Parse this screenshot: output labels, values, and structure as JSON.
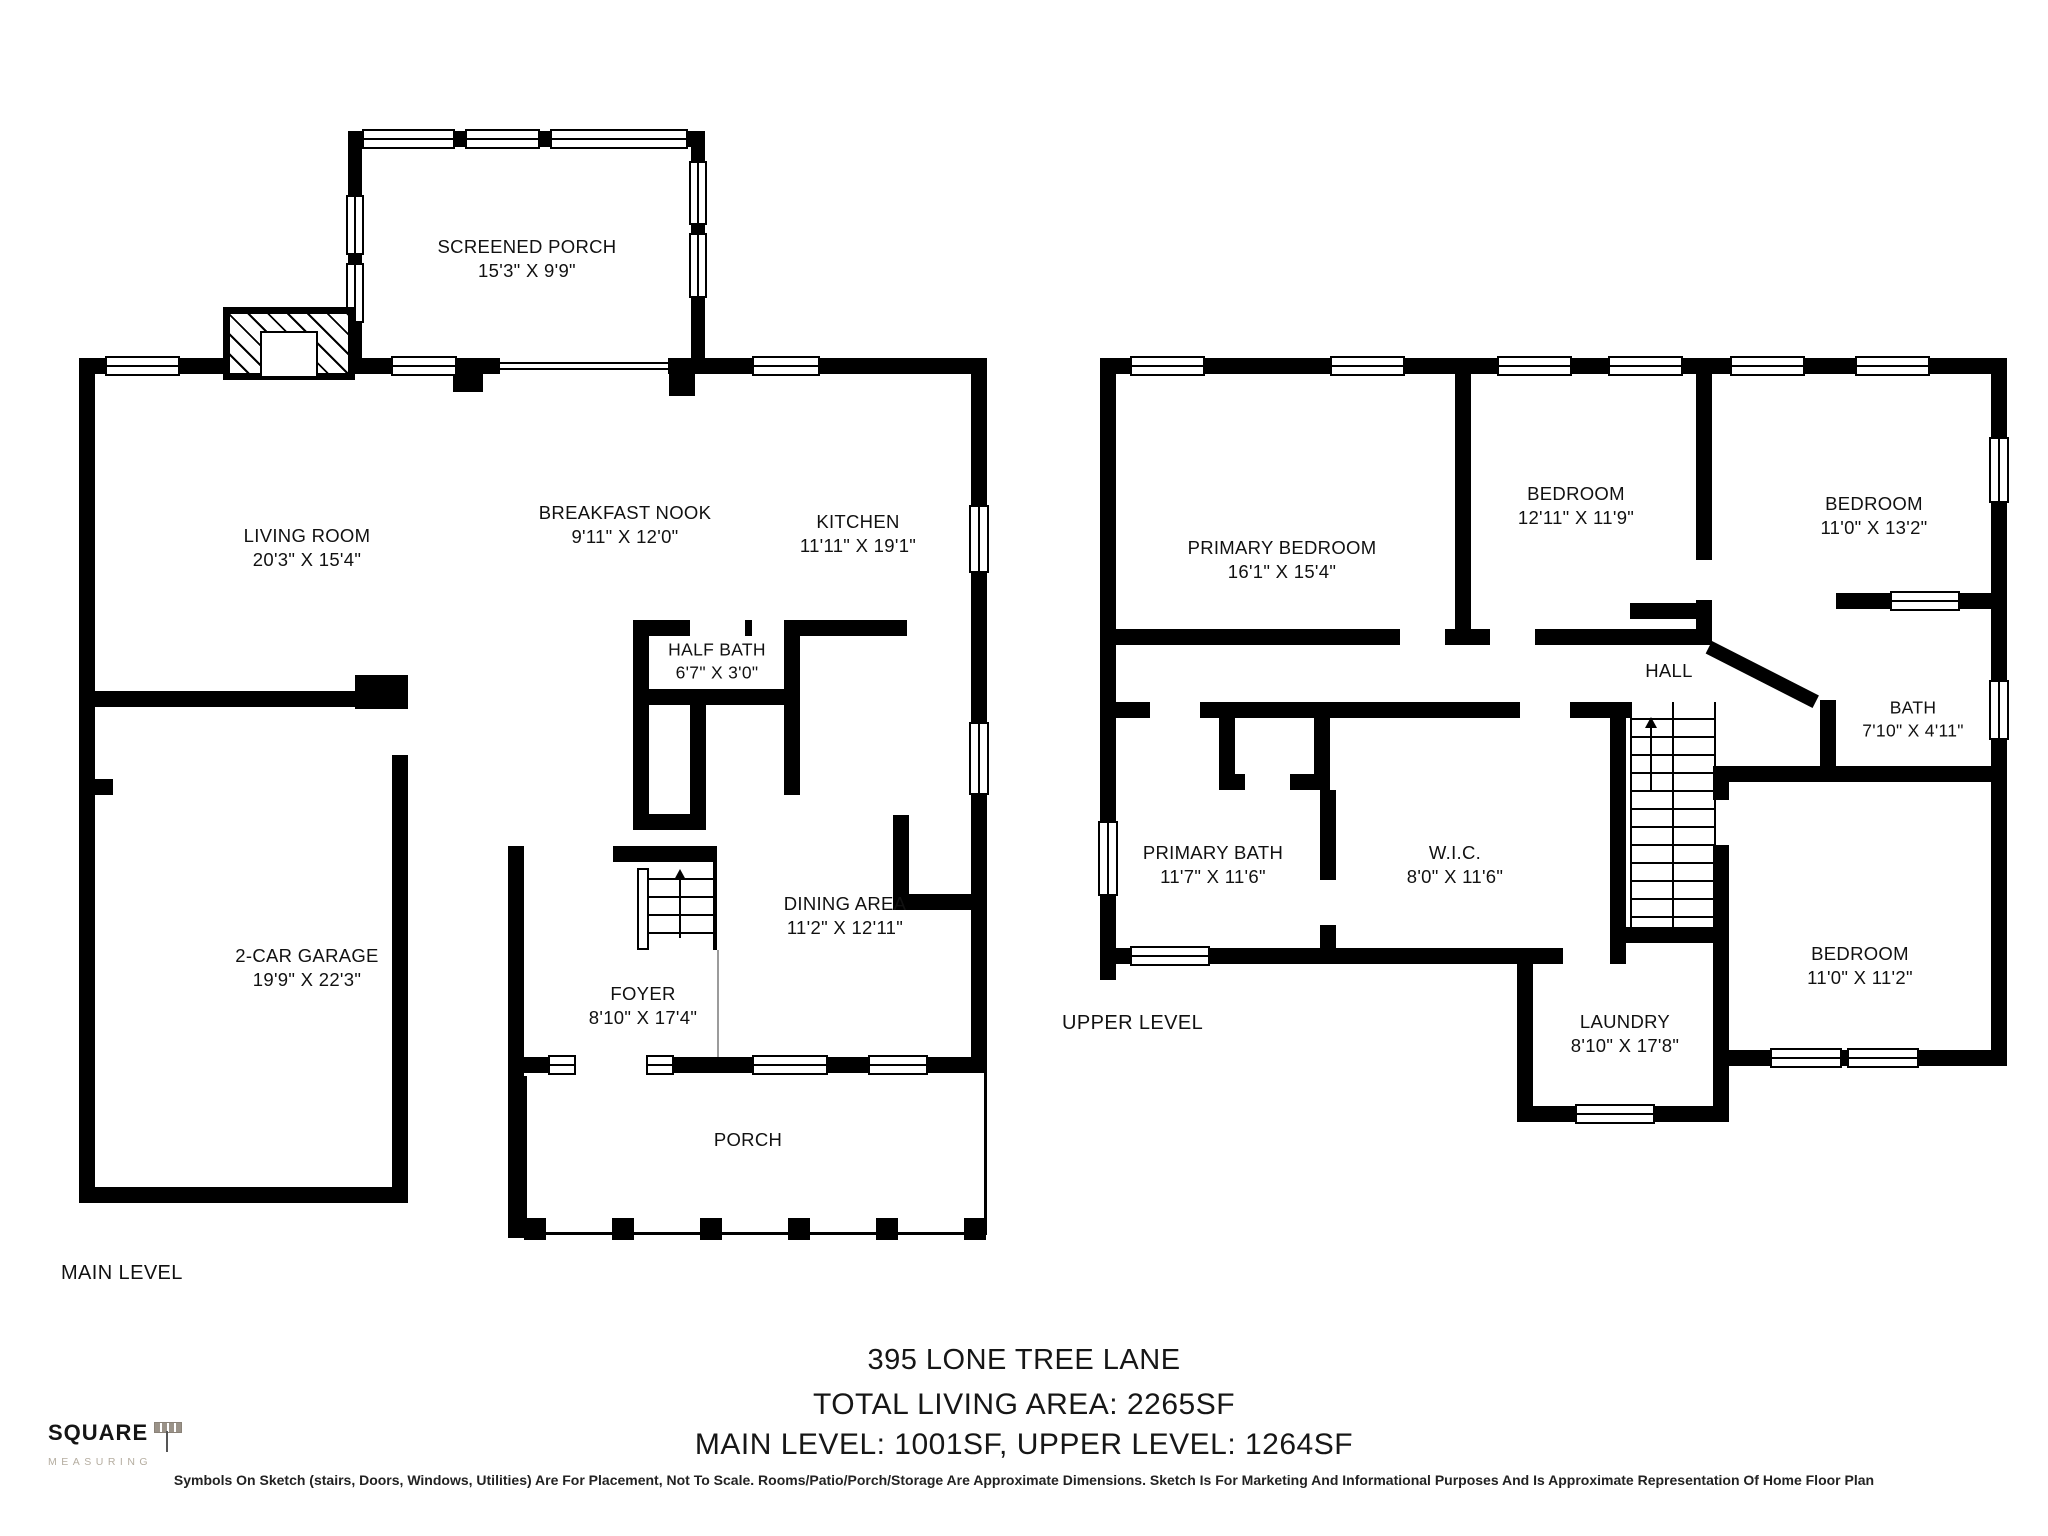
{
  "footer": {
    "address": "395 LONE TREE LANE",
    "total_area": "TOTAL LIVING AREA: 2265SF",
    "level_areas": "MAIN LEVEL: 1001SF, UPPER LEVEL: 1264SF",
    "disclaimer": "Symbols On Sketch (stairs, Doors, Windows, Utilities) Are For Placement, Not To Scale. Rooms/Patio/Porch/Storage Are Approximate Dimensions. Sketch Is For Marketing And Informational Purposes And Is Approximate Representation Of Home Floor Plan"
  },
  "logo": {
    "name": "SQUARE",
    "tagline": "MEASURING"
  },
  "levels": {
    "main": "MAIN LEVEL",
    "upper": "UPPER LEVEL"
  },
  "rooms": {
    "main": [
      {
        "name": "SCREENED PORCH",
        "dims": "15'3\" X 9'9\""
      },
      {
        "name": "LIVING ROOM",
        "dims": "20'3\" X 15'4\""
      },
      {
        "name": "BREAKFAST NOOK",
        "dims": "9'11\" X 12'0\""
      },
      {
        "name": "KITCHEN",
        "dims": "11'11\" X 19'1\""
      },
      {
        "name": "HALF BATH",
        "dims": "6'7\" X 3'0\""
      },
      {
        "name": "DINING AREA",
        "dims": "11'2\" X 12'11\""
      },
      {
        "name": "2-CAR GARAGE",
        "dims": "19'9\" X 22'3\""
      },
      {
        "name": "FOYER",
        "dims": "8'10\" X 17'4\""
      },
      {
        "name": "PORCH",
        "dims": ""
      }
    ],
    "upper": [
      {
        "name": "PRIMARY BEDROOM",
        "dims": "16'1\" X 15'4\""
      },
      {
        "name": "BEDROOM",
        "dims": "12'11\" X 11'9\""
      },
      {
        "name": "BEDROOM",
        "dims": "11'0\" X 13'2\""
      },
      {
        "name": "HALL",
        "dims": ""
      },
      {
        "name": "BATH",
        "dims": "7'10\" X 4'11\""
      },
      {
        "name": "PRIMARY BATH",
        "dims": "11'7\" X 11'6\""
      },
      {
        "name": "W.I.C.",
        "dims": "8'0\" X 11'6\""
      },
      {
        "name": "BEDROOM",
        "dims": "11'0\" X 11'2\""
      },
      {
        "name": "LAUNDRY",
        "dims": "8'10\" X 17'8\""
      }
    ]
  },
  "colors": {
    "wall": "#000000",
    "text": "#1a1a1a",
    "logo_gray": "#b5ada0"
  }
}
